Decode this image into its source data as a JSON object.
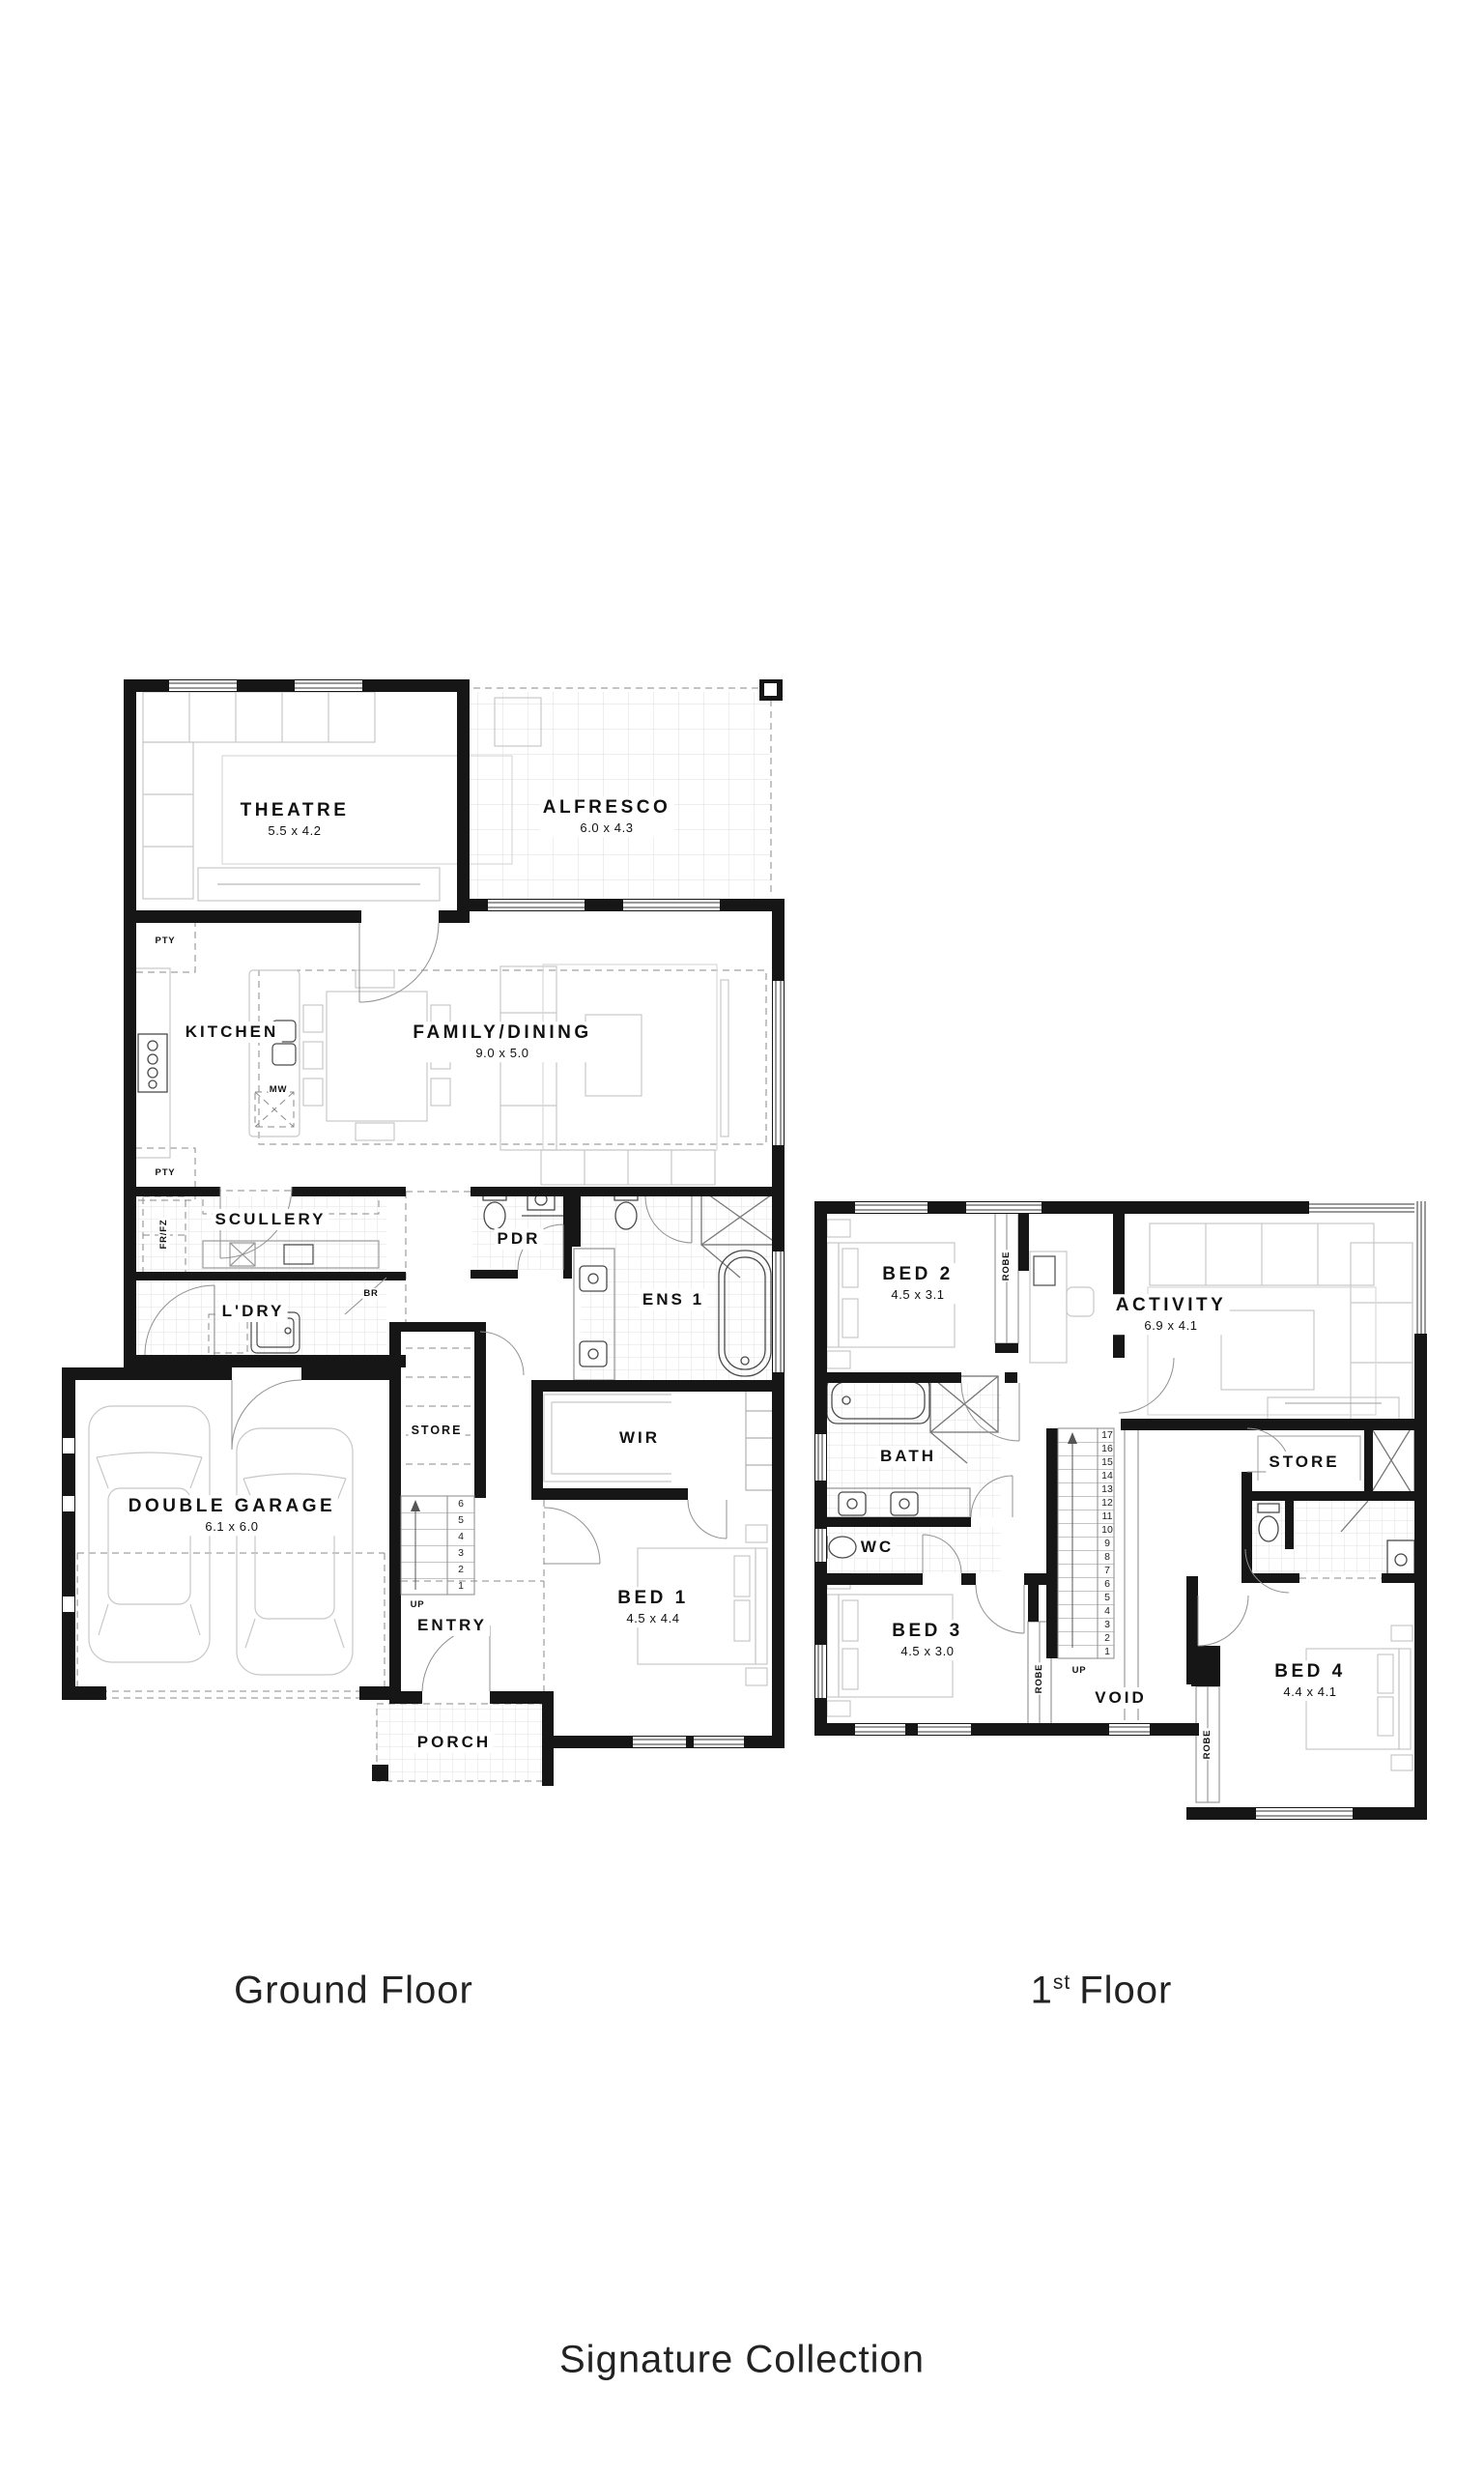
{
  "captions": {
    "ground_floor": "Ground Floor",
    "first_floor_number": "1",
    "first_floor_ordinal": "st",
    "first_floor_word": "Floor",
    "collection": "Signature Collection"
  },
  "ground": {
    "rooms": {
      "theatre": {
        "name": "THEATRE",
        "dims": "5.5 x 4.2"
      },
      "alfresco": {
        "name": "ALFRESCO",
        "dims": "6.0 x 4.3"
      },
      "kitchen": {
        "name": "KITCHEN"
      },
      "family": {
        "name": "FAMILY/DINING",
        "dims": "9.0 x 5.0"
      },
      "scullery": {
        "name": "SCULLERY"
      },
      "pdr": {
        "name": "PDR"
      },
      "ldry": {
        "name": "L'DRY"
      },
      "ens1": {
        "name": "ENS 1"
      },
      "garage": {
        "name": "DOUBLE GARAGE",
        "dims": "6.1 x 6.0"
      },
      "store": {
        "name": "STORE"
      },
      "entry": {
        "name": "ENTRY"
      },
      "wir": {
        "name": "WIR"
      },
      "bed1": {
        "name": "BED 1",
        "dims": "4.5 x 4.4"
      },
      "porch": {
        "name": "PORCH"
      }
    },
    "labels": {
      "pty_top": "PTY",
      "pty_bottom": "PTY",
      "mw": "MW",
      "fr_fz": "FR/FZ",
      "br": "BR",
      "up": "UP"
    },
    "stairs": [
      "6",
      "5",
      "4",
      "3",
      "2",
      "1"
    ]
  },
  "first": {
    "rooms": {
      "bed2": {
        "name": "BED 2",
        "dims": "4.5 x 3.1"
      },
      "activity": {
        "name": "ACTIVITY",
        "dims": "6.9 x 4.1"
      },
      "bath": {
        "name": "BATH"
      },
      "wc": {
        "name": "WC"
      },
      "bed3": {
        "name": "BED 3",
        "dims": "4.5 x 3.0"
      },
      "void": {
        "name": "VOID"
      },
      "store": {
        "name": "STORE"
      },
      "bed4": {
        "name": "BED 4",
        "dims": "4.4 x 4.1"
      }
    },
    "labels": {
      "robe_bed2": "ROBE",
      "robe_bed3": "ROBE",
      "robe_bed4": "ROBE",
      "up": "UP"
    },
    "stairs": [
      "17",
      "16",
      "15",
      "14",
      "13",
      "12",
      "11",
      "10",
      "9",
      "8",
      "7",
      "6",
      "5",
      "4",
      "3",
      "2",
      "1"
    ]
  },
  "colors": {
    "wall": "#161616",
    "furniture": "#c8c8c8",
    "fixture": "#4a4a4a",
    "tile": "#e2e2e2",
    "door_arc": "#909090",
    "text": "#111111"
  }
}
